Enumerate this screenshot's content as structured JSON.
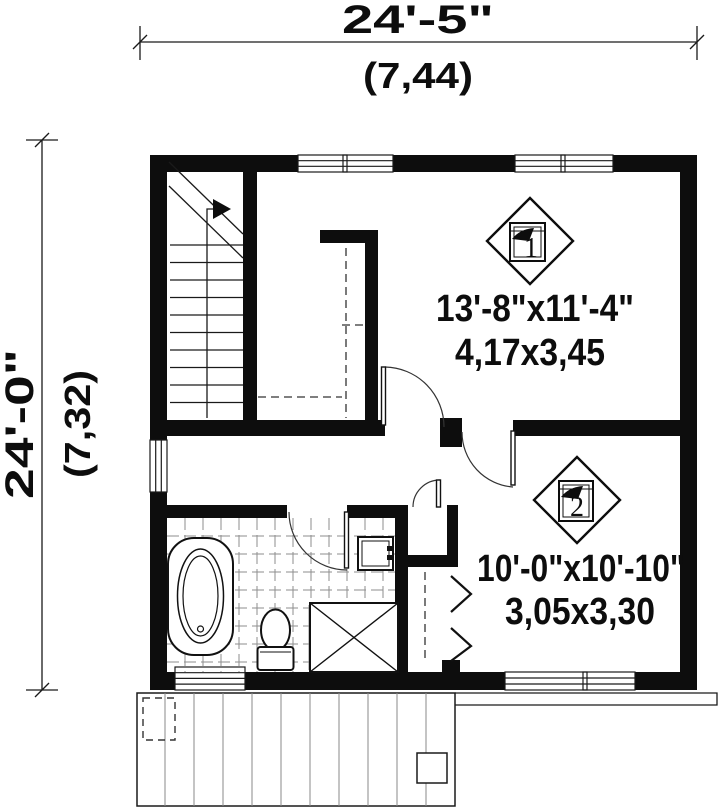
{
  "dimensions": {
    "top": {
      "imperial": "24'-5\"",
      "metric": "(7,44)"
    },
    "left": {
      "imperial": "24'-0\"",
      "metric": "(7,32)"
    }
  },
  "rooms": {
    "bedroom1": {
      "marker": "1",
      "imperial": "13'-8\"x11'-4\"",
      "metric": "4,17x3,45"
    },
    "bedroom2": {
      "marker": "2",
      "imperial": "10'-0\"x10'-10\"",
      "metric": "3,05x3,30"
    }
  },
  "colors": {
    "wall": "#0d0d0d",
    "line": "#1a1a1a",
    "tile_grout": "#8d8d8d",
    "background": "#ffffff"
  }
}
